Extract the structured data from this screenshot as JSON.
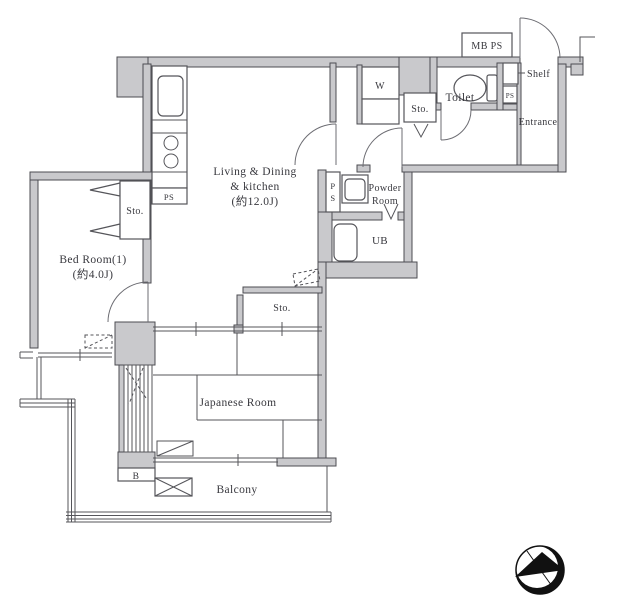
{
  "plan": {
    "rooms": {
      "living_dining_kitchen": {
        "label_line1": "Living & Dining",
        "label_line2": "& kitchen",
        "label_line3": "(約12.0J)"
      },
      "bedroom": {
        "label_line1": "Bed Room(1)",
        "label_line2": "(約4.0J)"
      },
      "japanese_room": {
        "label": "Japanese Room"
      },
      "powder_room": {
        "label_line1": "Powder",
        "label_line2": "Room"
      },
      "unit_bath": {
        "label": "UB"
      },
      "toilet": {
        "label": "Toilet"
      },
      "entrance": {
        "label": "Entrance"
      },
      "balcony": {
        "label": "Balcony"
      }
    },
    "fixtures": {
      "washer": {
        "label": "W"
      },
      "storage_hall": {
        "label": "Sto."
      },
      "storage_bedroom": {
        "label": "Sto."
      },
      "storage_middle": {
        "label": "Sto."
      },
      "meter_box": {
        "label": "MB PS"
      },
      "shelf": {
        "label": "Shelf"
      },
      "pipe_space_kitchen": {
        "label": "PS"
      },
      "pipe_space_vertical": {
        "letter_top": "P",
        "letter_bottom": "S"
      },
      "pipe_space_small": {
        "label": "PS"
      },
      "balcony_marker": {
        "label": "B"
      }
    },
    "colors": {
      "wall_fill": "#c9c9cc",
      "wall_outline": "#4c4c52",
      "line": "#55555a",
      "text": "#38383e",
      "background": "#ffffff",
      "compass": "#111111"
    },
    "icons": {
      "compass": "north-arrow-compass"
    }
  }
}
